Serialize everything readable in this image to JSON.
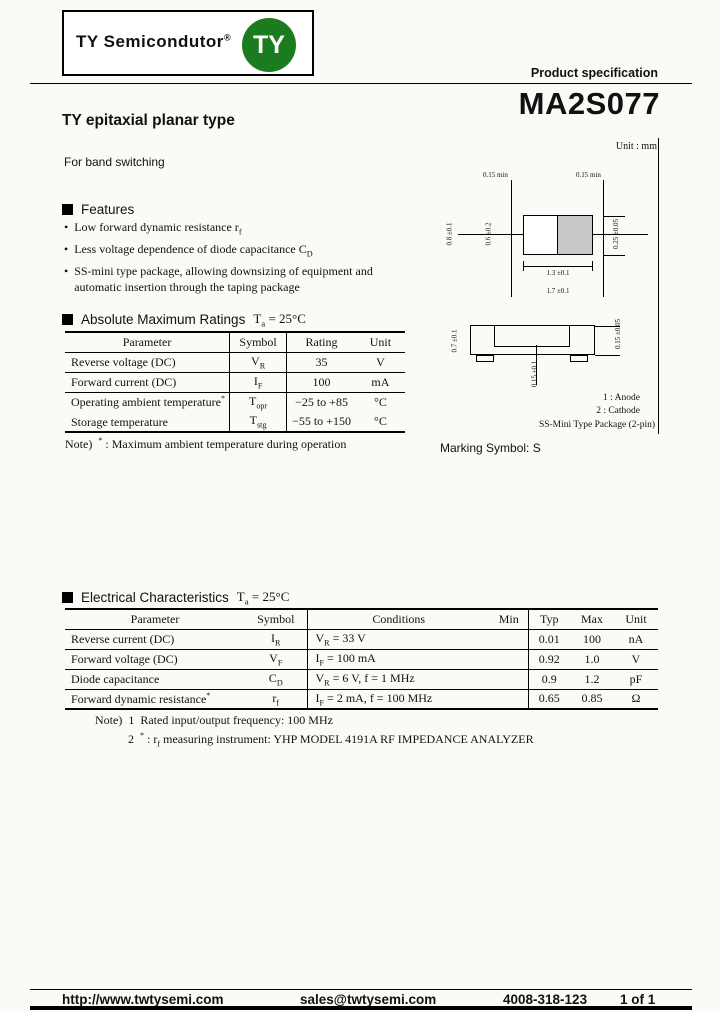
{
  "colors": {
    "brand_green": "#1a7c1e",
    "cathode_band_gray": "#c9c9c9",
    "page_bg": "#fafaf7",
    "text": "#111111"
  },
  "header": {
    "logo_text": "TY Semicondutor",
    "logo_reg": "®",
    "logo_badge": "TY",
    "spec_label": "Product specification",
    "part_number": "MA2S077"
  },
  "intro": {
    "title": "TY epitaxial planar type",
    "subtitle": "For band switching"
  },
  "features": {
    "heading": "Features",
    "bullet": "•",
    "items": [
      {
        "text": "Low forward dynamic resistance r",
        "sub": "f"
      },
      {
        "text": "Less voltage dependence of diode capacitance C",
        "sub": "D"
      },
      {
        "text": "SS-mini type package, allowing downsizing of equipment and automatic insertion through the taping package",
        "sub": ""
      }
    ]
  },
  "package": {
    "unit_label": "Unit : mm",
    "dims": {
      "lead_left": "0.15 min",
      "lead_right": "0.15 min",
      "height_outer": "0.8 ±0.1",
      "height_inner": "0.6 ±0.2",
      "band_width": "0.25 ±0.05",
      "body_width": "1.3 ±0.1",
      "overall_width": "1.7 ±0.1",
      "side_height": "0.7 ±0.1",
      "lead_thickness": "0.15 ±0.05",
      "standoff": "0.15 ±0.1"
    },
    "pin1": "1 : Anode",
    "pin2": "2 : Cathode",
    "type_label": "SS-Mini Type Package (2-pin)",
    "marking": "Marking Symbol: S"
  },
  "amr": {
    "heading": "Absolute Maximum Ratings",
    "temp": {
      "base": "T",
      "sub": "a",
      "rest": " = 25°C"
    },
    "headers": [
      "Parameter",
      "Symbol",
      "Rating",
      "Unit"
    ],
    "rows": [
      {
        "param": "Reverse voltage (DC)",
        "sup": "",
        "sym": "V",
        "sub": "R",
        "rating": "35",
        "unit": "V"
      },
      {
        "param": "Forward current (DC)",
        "sup": "",
        "sym": "I",
        "sub": "F",
        "rating": "100",
        "unit": "mA"
      },
      {
        "param": "Operating ambient temperature",
        "sup": "*",
        "sym": "T",
        "sub": "opr",
        "rating": "−25 to +85",
        "unit": "°C"
      },
      {
        "param": "Storage temperature",
        "sup": "",
        "sym": "T",
        "sub": "stg",
        "rating": "−55 to +150",
        "unit": "°C"
      }
    ],
    "note": {
      "label": "Note)",
      "sup": "*",
      "text": " : Maximum ambient temperature during operation"
    }
  },
  "ec": {
    "heading": "Electrical Characteristics",
    "temp": {
      "base": "T",
      "sub": "a",
      "rest": " = 25°C"
    },
    "headers": {
      "param": "Parameter",
      "symbol": "Symbol",
      "conditions": "Conditions",
      "min": "Min",
      "typ": "Typ",
      "max": "Max",
      "unit": "Unit"
    },
    "rows": [
      {
        "param": "Reverse current (DC)",
        "sup": "",
        "sym": "I",
        "sub": "R",
        "cond_base": "V",
        "cond_sub": "R",
        "cond_rest": " = 33 V",
        "min": "",
        "typ": "0.01",
        "max": "100",
        "unit": "nA"
      },
      {
        "param": "Forward voltage (DC)",
        "sup": "",
        "sym": "V",
        "sub": "F",
        "cond_base": "I",
        "cond_sub": "F",
        "cond_rest": " = 100 mA",
        "min": "",
        "typ": "0.92",
        "max": "1.0",
        "unit": "V"
      },
      {
        "param": "Diode capacitance",
        "sup": "",
        "sym": "C",
        "sub": "D",
        "cond_base": "V",
        "cond_sub": "R",
        "cond_rest": " = 6 V, f = 1 MHz",
        "min": "",
        "typ": "0.9",
        "max": "1.2",
        "unit": "pF"
      },
      {
        "param": "Forward dynamic resistance",
        "sup": "*",
        "sym": "r",
        "sub": "f",
        "cond_base": "I",
        "cond_sub": "F",
        "cond_rest": " = 2 mA, f = 100 MHz",
        "min": "",
        "typ": "0.65",
        "max": "0.85",
        "unit": "Ω"
      }
    ],
    "notes": {
      "label": "Note)",
      "n1_num": "1",
      "n1_text": "Rated input/output frequency: 100 MHz",
      "n2_num": "2",
      "n2_sup": "*",
      "n2_pre": " : r",
      "n2_sub": "f",
      "n2_rest": " measuring instrument: YHP MODEL 4191A RF IMPEDANCE ANALYZER"
    }
  },
  "footer": {
    "url": "http://www.twtysemi.com",
    "email": "sales@twtysemi.com",
    "phone": "4008-318-123",
    "page": "1 of 1"
  }
}
